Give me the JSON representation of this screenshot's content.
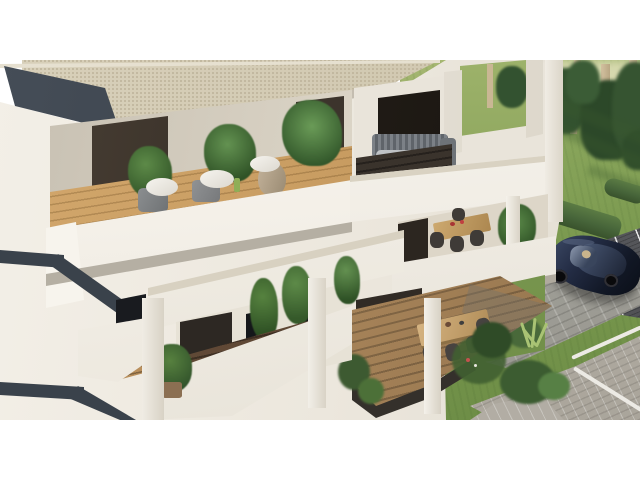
{
  "meta": {
    "type": "architectural-3d-render",
    "description": "Aerial three-quarter 3D rendering of a modern two-storey white apartment building with tiered balconies, landscaped garden, paved paths, parking bay and a dark sedan",
    "canvas": "letterboxed 16:9 render centered on white 640x480 canvas"
  },
  "palette": {
    "sky": "#ffffff",
    "roof_beige": "#d3cab3",
    "fascia_charcoal": "#3a424b",
    "wall_white": "#f2eee6",
    "wood_light": "#cfa468",
    "wood_dark": "#5f4936",
    "deck_brown": "#a9855a",
    "lawn_green": "#7f9c53",
    "conifer_green": "#2c4829",
    "hedge_green": "#4e6e3a",
    "asphalt": "#55575b",
    "paver_gray": "#b7b2a9",
    "car_navy": "#1a2336"
  },
  "scene": {
    "building": {
      "label": "two-storey apartment block",
      "features": [
        "beige roof slab",
        "charcoal trim bands",
        "white columns",
        "floor-to-ceiling glazing"
      ],
      "balconies": [
        {
          "label": "upper-left balcony",
          "items": [
            "white lounge cushions",
            "potted plants",
            "terracotta urn",
            "light timber deck"
          ]
        },
        {
          "label": "upper-right balcony",
          "items": [
            "slatted grey sofa",
            "dark timber deck"
          ]
        },
        {
          "label": "middle-right balcony",
          "items": [
            "timber dining table",
            "dark chairs",
            "potted plant"
          ]
        },
        {
          "label": "ground-left terrace",
          "items": [
            "dark timber deck",
            "tall potted plants"
          ]
        },
        {
          "label": "ground-right terrace",
          "items": [
            "outdoor dining table",
            "woven chairs",
            "timber deck"
          ]
        }
      ]
    },
    "landscape": {
      "label": "garden",
      "items": [
        "lawn",
        "conifer trees",
        "tree trunks",
        "clipped L-shaped hedge",
        "ornamental grasses",
        "shrubs",
        "tree shadows"
      ]
    },
    "hardscape": {
      "items": [
        "dark parking bay with white lines",
        "grey paver walkway",
        "paver patio with white edging"
      ]
    },
    "vehicle": {
      "label": "dark blue sedan",
      "location": "parking bay, right side"
    }
  }
}
